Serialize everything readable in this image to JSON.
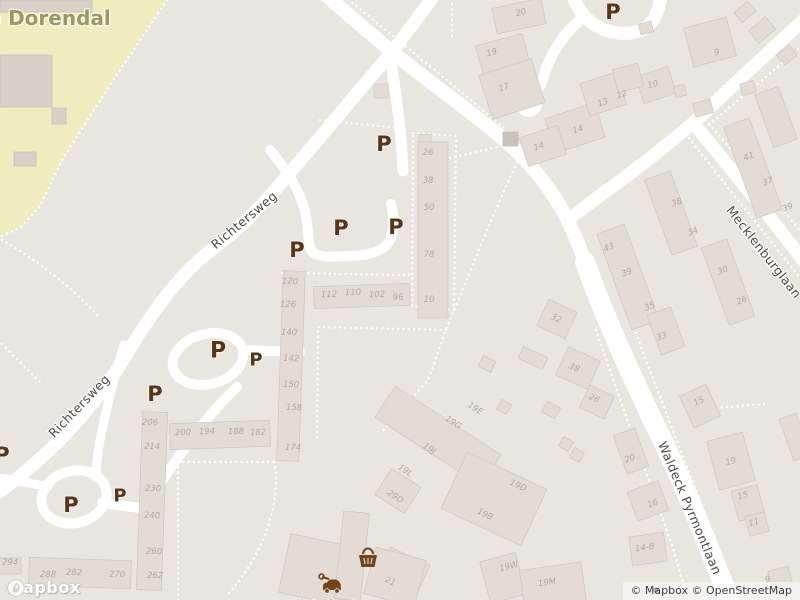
{
  "map": {
    "place_labels": [
      {
        "text": "de Dorendal",
        "x": 42,
        "y": 18,
        "rot": 0
      }
    ],
    "street_labels": [
      {
        "text": "Richtersweg",
        "x": 244,
        "y": 220,
        "rot": -40
      },
      {
        "text": "Richtersweg",
        "x": 79,
        "y": 406,
        "rot": -46
      },
      {
        "text": "Mecklenburglaan",
        "x": 764,
        "y": 252,
        "rot": 52
      },
      {
        "text": "Waldeck Pyrmontlaan",
        "x": 690,
        "y": 508,
        "rot": 67
      }
    ],
    "parking": {
      "label": "P",
      "markers": [
        {
          "x": 613,
          "y": 12,
          "size": 21
        },
        {
          "x": 384,
          "y": 144,
          "size": 21
        },
        {
          "x": 341,
          "y": 228,
          "size": 21
        },
        {
          "x": 396,
          "y": 227,
          "size": 21
        },
        {
          "x": 297,
          "y": 250,
          "size": 21
        },
        {
          "x": 218,
          "y": 351,
          "size": 22
        },
        {
          "x": 256,
          "y": 360,
          "size": 18
        },
        {
          "x": 155,
          "y": 394,
          "size": 21
        },
        {
          "x": 2,
          "y": 455,
          "size": 21
        },
        {
          "x": 120,
          "y": 496,
          "size": 18
        },
        {
          "x": 71,
          "y": 505,
          "size": 21
        }
      ]
    },
    "house_numbers": [
      [
        "20",
        521,
        13,
        -15
      ],
      [
        "19",
        492,
        53,
        -15
      ],
      [
        "17",
        504,
        88,
        -18
      ],
      [
        "13",
        603,
        103,
        -18
      ],
      [
        "12",
        622,
        95,
        -15
      ],
      [
        "10",
        653,
        85,
        -15
      ],
      [
        "9",
        717,
        53,
        -15
      ],
      [
        "14",
        578,
        130,
        -18
      ],
      [
        "14",
        539,
        147,
        -18
      ],
      [
        "41",
        749,
        157,
        -20
      ],
      [
        "37",
        768,
        182,
        -20
      ],
      [
        "39",
        788,
        208,
        -20
      ],
      [
        "38",
        677,
        203,
        -20
      ],
      [
        "34",
        693,
        232,
        -20
      ],
      [
        "43",
        609,
        248,
        -20
      ],
      [
        "39",
        627,
        273,
        -20
      ],
      [
        "35",
        650,
        307,
        -20
      ],
      [
        "33",
        662,
        337,
        -20
      ],
      [
        "30",
        723,
        271,
        -20
      ],
      [
        "26",
        742,
        301,
        -20
      ],
      [
        "32",
        556,
        319,
        25
      ],
      [
        "38",
        574,
        368,
        25
      ],
      [
        "26",
        594,
        399,
        25
      ],
      [
        "15",
        699,
        402,
        -25
      ],
      [
        "20",
        630,
        459,
        -20
      ],
      [
        "19",
        731,
        462,
        -15
      ],
      [
        "15",
        743,
        496,
        -15
      ],
      [
        "11",
        754,
        523,
        -15
      ],
      [
        "16",
        653,
        504,
        -20
      ],
      [
        "14-B",
        645,
        548,
        -8
      ],
      [
        "9",
        768,
        580,
        -15
      ],
      [
        "19E",
        475,
        409,
        33
      ],
      [
        "19G",
        453,
        423,
        33
      ],
      [
        "19J",
        429,
        449,
        33
      ],
      [
        "19L",
        405,
        471,
        33
      ],
      [
        "29D",
        395,
        497,
        33
      ],
      [
        "19D",
        518,
        486,
        25
      ],
      [
        "19B",
        485,
        515,
        25
      ],
      [
        "19W",
        509,
        567,
        -15
      ],
      [
        "19M",
        547,
        583,
        -8
      ],
      [
        "21",
        390,
        582,
        25
      ],
      [
        "26",
        428,
        153,
        0
      ],
      [
        "38",
        428,
        181,
        0
      ],
      [
        "50",
        429,
        208,
        0
      ],
      [
        "78",
        429,
        255,
        0
      ],
      [
        "10",
        429,
        300,
        0
      ],
      [
        "112",
        329,
        295,
        -2
      ],
      [
        "110",
        353,
        293,
        -2
      ],
      [
        "102",
        377,
        295,
        -2
      ],
      [
        "96",
        398,
        298,
        -2
      ],
      [
        "120",
        290,
        282,
        2
      ],
      [
        "126",
        288,
        305,
        2
      ],
      [
        "140",
        289,
        333,
        2
      ],
      [
        "142",
        291,
        359,
        2
      ],
      [
        "150",
        291,
        385,
        2
      ],
      [
        "158",
        294,
        408,
        2
      ],
      [
        "174",
        293,
        448,
        2
      ],
      [
        "206",
        150,
        423,
        2
      ],
      [
        "214",
        152,
        447,
        2
      ],
      [
        "230",
        153,
        489,
        2
      ],
      [
        "240",
        152,
        516,
        2
      ],
      [
        "260",
        154,
        552,
        2
      ],
      [
        "262",
        155,
        576,
        2
      ],
      [
        "200",
        183,
        433,
        -2
      ],
      [
        "194",
        207,
        432,
        -2
      ],
      [
        "188",
        236,
        432,
        -2
      ],
      [
        "182",
        258,
        433,
        -2
      ],
      [
        "294",
        10,
        563,
        2
      ],
      [
        "288",
        48,
        575,
        2
      ],
      [
        "282",
        74,
        573,
        2
      ],
      [
        "270",
        117,
        575,
        2
      ]
    ],
    "poi_labels": [
      {
        "text": "Auto Service",
        "x": 333,
        "y": 604
      }
    ],
    "colors": {
      "land": "#e9e5df",
      "park": "#f0ecbd",
      "road": "#ffffff",
      "building": "#e3dcd5",
      "building_outline": "#cfc6bd",
      "parking_marker": "#573516",
      "street_text": "#4e4a45",
      "house_number_text": "#b2a89d",
      "park_text": "#9a9a5f",
      "poi_brown": "#744317"
    }
  },
  "attribution": {
    "logo_text": "mapbox",
    "copyright": "© Mapbox © OpenStreetMap"
  }
}
